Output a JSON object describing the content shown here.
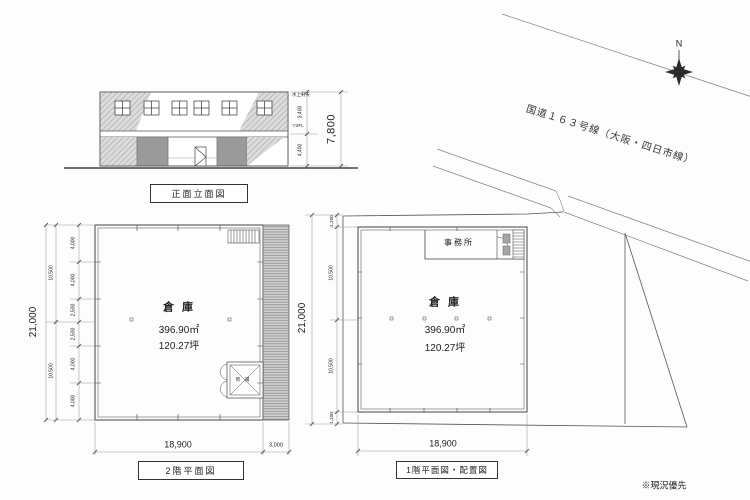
{
  "elevation": {
    "title": "正面立面図",
    "dims": {
      "total": "7,800",
      "upper": "3,400",
      "lower": "4,400"
    },
    "notes": {
      "top": "水上軒天",
      "level": "▽2FL"
    }
  },
  "plan2f": {
    "title": "2階平面図",
    "room": "倉庫",
    "area_m2": "396.90㎡",
    "area_tsubo": "120.27坪",
    "hoist": "荷揚",
    "dims": {
      "total_v": "21,000",
      "groups": [
        "10,500",
        "10,500"
      ],
      "chain": [
        "4,000",
        "4,000",
        "2,500",
        "2,500",
        "4,000",
        "4,000"
      ],
      "width": "18,900",
      "strip": "3,000"
    }
  },
  "plan1f": {
    "title": "1階平面図・配置図",
    "office": "事務所",
    "room": "倉庫",
    "area_m2": "396.90㎡",
    "area_tsubo": "120.27坪",
    "dims": {
      "total_v": "21,000",
      "chain": [
        "1,100",
        "10,500",
        "10,500",
        "1,100"
      ],
      "width": "18,900"
    }
  },
  "site": {
    "road": "国道１６３号線（大阪・四日市線）",
    "north": "N",
    "note": "※現況優先"
  }
}
